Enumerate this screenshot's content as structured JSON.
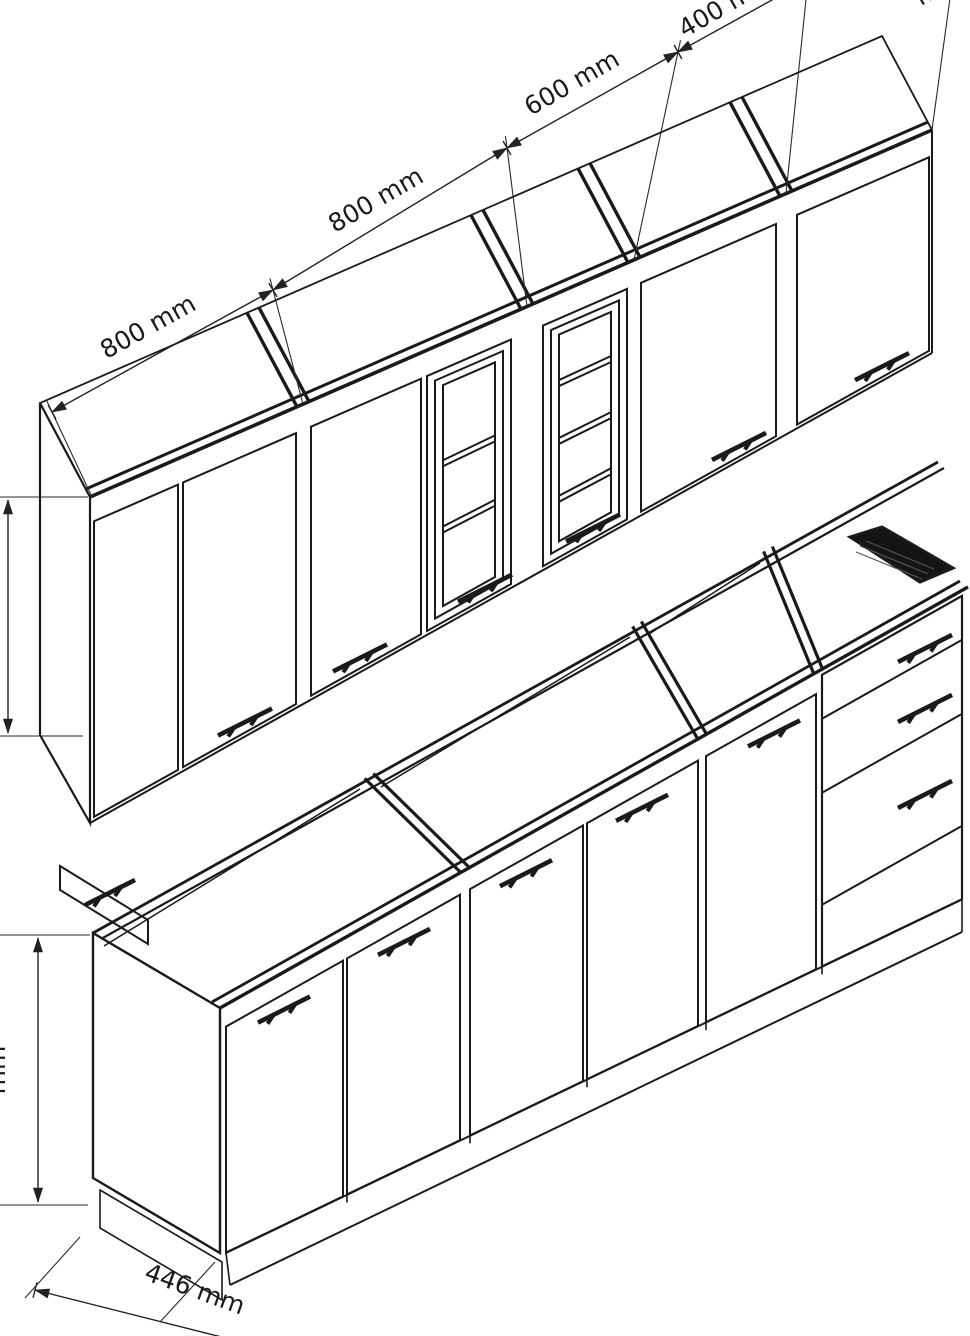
{
  "drawing": {
    "type": "technical-line-drawing",
    "subject": "Kitchen cabinet assembly, isometric view: upper wall cabinet row and base cabinet row with open worktop frame",
    "background_color": "#ffffff",
    "line_color": "#1a1a1a"
  },
  "dimensions": {
    "width_1": "800 mm",
    "width_2": "800 mm",
    "width_3": "600 mm",
    "width_4": "400 mm",
    "width_5_clipped": "mm",
    "depth": "446 mm",
    "height_left_clipped": "mm"
  },
  "wall_row": {
    "units": [
      "double-door wall cabinet 800 mm",
      "double-door wall cabinet 800 mm",
      "glass-door wall cabinet 600 mm with interior shelves",
      "single-door wall cabinet 400 mm",
      "single-door wall cabinet (clipped at right edge)"
    ]
  },
  "base_row": {
    "units": [
      "base cabinets with five doors, open top frame (no worktop)",
      "drawer unit with three drawer fronts and dark hatched cutout opening",
      "left end panel with plinth"
    ]
  }
}
